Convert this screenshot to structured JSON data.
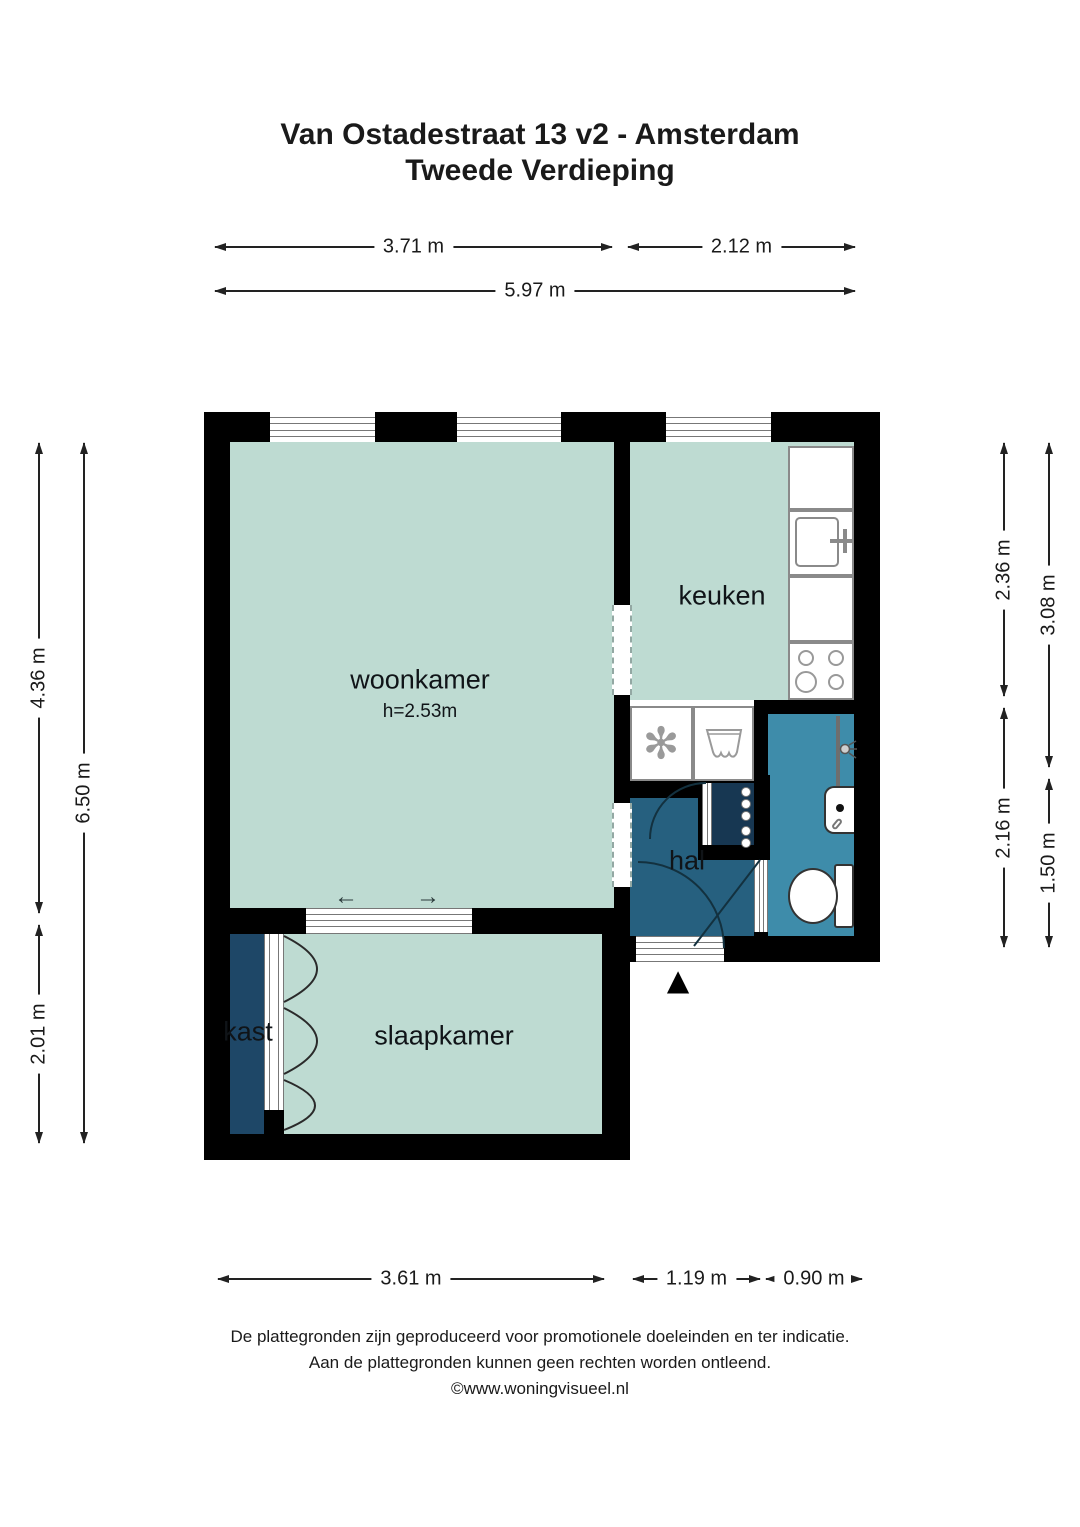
{
  "title": {
    "line1": "Van Ostadestraat 13 v2 - Amsterdam",
    "line2": "Tweede Verdieping"
  },
  "rooms": {
    "woonkamer": {
      "label": "woonkamer",
      "ceiling_height": "h=2.53m"
    },
    "keuken": {
      "label": "keuken"
    },
    "hal": {
      "label": "hal"
    },
    "slaapkamer": {
      "label": "slaapkamer"
    },
    "kast": {
      "label": "kast"
    }
  },
  "dims": {
    "top_left": "3.71 m",
    "top_right": "2.12 m",
    "top_total": "5.97 m",
    "left_upper": "4.36 m",
    "left_lower": "2.01 m",
    "left_total": "6.50 m",
    "right_inner_upper": "2.36 m",
    "right_inner_lower": "2.16 m",
    "right_outer_upper": "3.08 m",
    "right_outer_lower": "1.50 m",
    "bottom_left": "3.61 m",
    "bottom_middle": "1.19 m",
    "bottom_right": "0.90 m"
  },
  "glyphs": {
    "fan": "✻",
    "arrow_left": "←",
    "arrow_right": "→",
    "entrance_marker": "▲"
  },
  "footer": {
    "line1": "De plattegronden zijn geproduceerd voor promotionele doeleinden en ter indicatie.",
    "line2": "Aan de plattegronden kunnen geen rechten worden ontleend.",
    "line3": "©www.woningvisueel.nl"
  },
  "colors": {
    "wall": "#000000",
    "room_fill": "#bedbd2",
    "bathroom_fill": "#3e8caa",
    "hall_fill": "#26607f",
    "closet_fill": "#1e4767",
    "meter_closet_fill": "#173752"
  }
}
